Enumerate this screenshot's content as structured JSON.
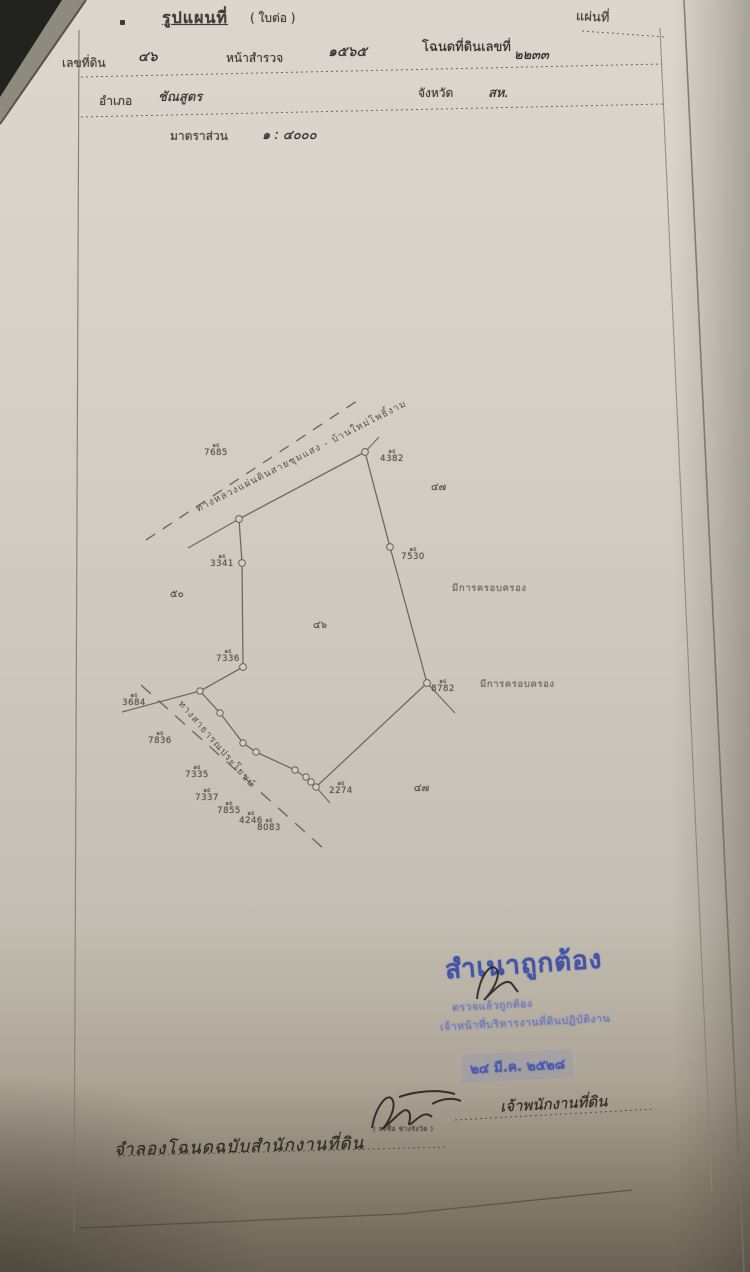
{
  "page": {
    "title": "รูปแผนที่",
    "title_suffix": "( ใบต่อ )",
    "sheet_label": "แผ่นที่",
    "fields": {
      "parcel_label": "เลขที่ดิน",
      "parcel_value": "๔๖",
      "survey_label": "หน้าสำรวจ",
      "survey_value": "๑๕๖๕",
      "deed_label": "โฉนดที่ดินเลขที่",
      "deed_value": "๒๒๓๓",
      "district_label": "อำเภอ",
      "district_value": "ชัณสูตร",
      "province_label": "จังหวัด",
      "province_value": "สห.",
      "scale_label": "มาตราส่วน",
      "scale_value": "๑ : ๔๐๐๐"
    },
    "map": {
      "road_top": "ทางหลวงแผ่นดินสายชุมแสง - บ้านใหม่โพธิ์งาม",
      "road_bottom": "ทางสาธารณประโยชน์",
      "note_right_1": "มีการครอบครอง",
      "note_right_2": "มีการครอบครอง",
      "neighbor_numbers": [
        "๔๗",
        "๕๐",
        "๔๖",
        "๔๗"
      ],
      "markers": [
        {
          "prefix": "๑ธ",
          "number": "7685"
        },
        {
          "prefix": "๑ธ",
          "number": "4382"
        },
        {
          "prefix": "๑ธ",
          "number": "3341"
        },
        {
          "prefix": "๑ธ",
          "number": "7530"
        },
        {
          "prefix": "๑ธ",
          "number": "7336"
        },
        {
          "prefix": "๑ธ",
          "number": "8782"
        },
        {
          "prefix": "๑ธ",
          "number": "3684"
        },
        {
          "prefix": "๑ธ",
          "number": "7836"
        },
        {
          "prefix": "๑ธ",
          "number": "7335"
        },
        {
          "prefix": "๑ธ",
          "number": "7337"
        },
        {
          "prefix": "๑ธ",
          "number": "7855"
        },
        {
          "prefix": "๑ธ",
          "number": "4246"
        },
        {
          "prefix": "๑ธ",
          "number": "8083"
        },
        {
          "prefix": "๑ธ",
          "number": "2274"
        }
      ]
    },
    "certification": {
      "stamp_title": "สำเนาถูกต้อง",
      "stamp_line1": "ตรวจแล้วถูกต้อง",
      "stamp_line2": "เจ้าหน้าที่บริหารงานที่ดินปฏิบัติงาน",
      "date_stamp": "๒๔ มี.ค. ๒๕๒๘",
      "signer_title": "เจ้าพนักงานที่ดิน",
      "signer_caption": "( ลงชื่อ ช่างรังวัด )",
      "bottom_note": "จำลองโฉนดฉบับสำนักงานที่ดิน"
    }
  }
}
